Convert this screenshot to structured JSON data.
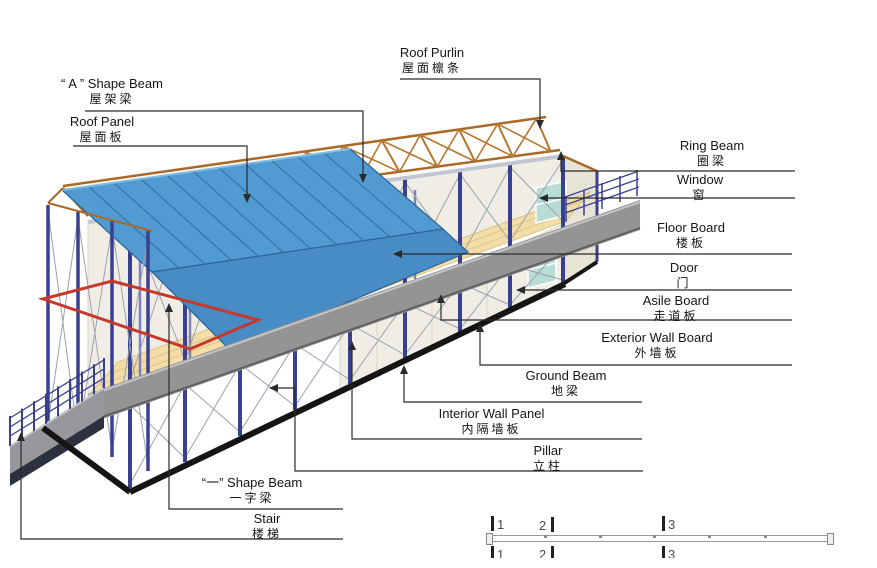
{
  "figure_type": "prefab-house-structure-diagram",
  "labels": {
    "a_shape_beam": {
      "en": "“ A ” Shape Beam",
      "zh": "屋架梁"
    },
    "roof_panel": {
      "en": "Roof Panel",
      "zh": "屋面板"
    },
    "roof_purlin": {
      "en": "Roof Purlin",
      "zh": "屋面檩条"
    },
    "ring_beam": {
      "en": "Ring Beam",
      "zh": "圈梁"
    },
    "window": {
      "en": "Window",
      "zh": "窗"
    },
    "floor_board": {
      "en": "Floor Board",
      "zh": "楼板"
    },
    "door": {
      "en": "Door",
      "zh": "门"
    },
    "asile_board": {
      "en": "Asile Board",
      "zh": "走道板"
    },
    "exterior_wall_board": {
      "en": "Exterior Wall Board",
      "zh": "外墙板"
    },
    "ground_beam": {
      "en": "Ground Beam",
      "zh": "地梁"
    },
    "interior_wall_panel": {
      "en": "Interior Wall Panel",
      "zh": "内隔墙板"
    },
    "pillar": {
      "en": "Pillar",
      "zh": "立柱"
    },
    "yi_shape_beam": {
      "en": "“一” Shape Beam",
      "zh": "一字梁"
    },
    "stair": {
      "en": "Stair",
      "zh": "楼梯"
    }
  },
  "scale_bar": {
    "marks": [
      "1",
      "2",
      "3"
    ]
  },
  "colors": {
    "background": "#ffffff",
    "roof_panel": "#529bd2",
    "roof_fascia": "#478cc4",
    "roof_truss": "#b06c28",
    "pillar": "#39408f",
    "wall_panel": "#f0eee4",
    "walkway": "#949494",
    "ground_beam": "#151515",
    "red_beam": "#c4392b",
    "window_glass": "#b7ddd4",
    "floor_wood": "#f3dda8",
    "leader_line": "#2a2a2a"
  }
}
